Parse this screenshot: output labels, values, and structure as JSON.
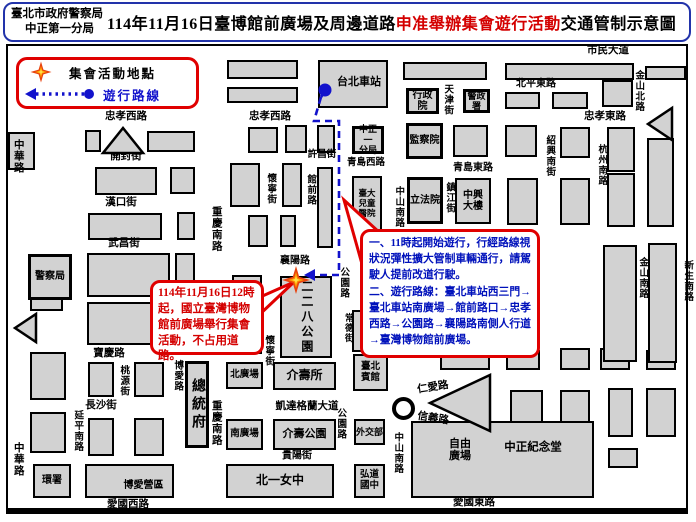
{
  "header": {
    "agency": "臺北市政府警察局",
    "precinct": "中正第一分局",
    "title_part1": "114年11月16日臺博館前廣場及周邊道路",
    "title_red": "申准舉辦集會遊行活動",
    "title_part2": "交通管制示意圖"
  },
  "legend": {
    "assembly_label": "集會活動地點",
    "route_label": "遊行路線"
  },
  "callouts": {
    "assembly_note": "114年11月16日12時起，國立臺灣博物館前廣場舉行集會活動，不占用道路。",
    "route_note": [
      "一、11時起開始遊行，行經路線視狀況彈性擴大管制車輛通行，請駕駛人提前改道行駛。",
      "二、遊行路線：臺北車站西三門→臺北車站南廣場→館前路口→忠孝西路→公園路→襄陽路南側人行道→臺灣博物館前廣場。"
    ]
  },
  "colors": {
    "accent_red": "#e00000",
    "route_blue": "#1212cc",
    "note_blue": "#0011bb",
    "block_gray": "#d2d2d2",
    "header_border_blue": "#2233aa"
  },
  "map": {
    "route": {
      "start": [
        325,
        90
      ],
      "points": [
        [
          321,
          97
        ],
        [
          314,
          121
        ],
        [
          339,
          121
        ],
        [
          339,
          275
        ],
        [
          313,
          275
        ]
      ],
      "arrow_tip": [
        304,
        275
      ],
      "star": [
        296,
        280
      ]
    },
    "roundabout": [
      392,
      397
    ],
    "labels": [
      {
        "text": "市民大道",
        "x": 608,
        "y": 51
      },
      {
        "text": "忠孝西路",
        "x": 126,
        "y": 117
      },
      {
        "text": "忠孝西路",
        "x": 270,
        "y": 117
      },
      {
        "text": "北平東路",
        "x": 536,
        "y": 84,
        "fs": 10
      },
      {
        "text": "忠孝東路",
        "x": 605,
        "y": 117
      },
      {
        "text": "開封街",
        "x": 126,
        "y": 157
      },
      {
        "text": "漢口街",
        "x": 121,
        "y": 203
      },
      {
        "text": "武昌街",
        "x": 124,
        "y": 244
      },
      {
        "text": "許昌街",
        "x": 322,
        "y": 155,
        "fs": 9.5
      },
      {
        "text": "青島西路",
        "x": 366,
        "y": 163,
        "fs": 9.5
      },
      {
        "text": "青島東路",
        "x": 473,
        "y": 168,
        "fs": 10
      },
      {
        "text": "襄陽路",
        "x": 295,
        "y": 261,
        "fs": 10
      },
      {
        "text": "寶慶路",
        "x": 109,
        "y": 354
      },
      {
        "text": "長沙街",
        "x": 101,
        "y": 406
      },
      {
        "text": "凱達格蘭大道",
        "x": 307,
        "y": 407
      },
      {
        "text": "貴陽街",
        "x": 297,
        "y": 456,
        "fs": 10
      },
      {
        "text": "愛國西路",
        "x": 128,
        "y": 505
      },
      {
        "text": "愛國東路",
        "x": 474,
        "y": 503
      },
      {
        "text": "仁愛路",
        "x": 433,
        "y": 388,
        "rot": -9
      },
      {
        "text": "信義路",
        "x": 433,
        "y": 419,
        "rot": 9
      },
      {
        "text": "自由\n廣場",
        "x": 460,
        "y": 450,
        "fs": 11
      },
      {
        "text": "中正紀念堂",
        "x": 533,
        "y": 448,
        "fs": 11.5
      },
      {
        "text": "中華路",
        "x": 18,
        "y": 156,
        "v": true
      },
      {
        "text": "中華路",
        "x": 18,
        "y": 459,
        "v": true
      },
      {
        "text": "重慶南路",
        "x": 216,
        "y": 229,
        "v": true
      },
      {
        "text": "重慶南路",
        "x": 216,
        "y": 423,
        "v": true
      },
      {
        "text": "天津街",
        "x": 447,
        "y": 100,
        "v": true,
        "fs": 9.5
      },
      {
        "text": "金山北路",
        "x": 638,
        "y": 91,
        "v": true,
        "fs": 9.5
      },
      {
        "text": "杭州南路",
        "x": 601,
        "y": 165,
        "v": true,
        "fs": 9.5
      },
      {
        "text": "紹興南街",
        "x": 549,
        "y": 156,
        "v": true,
        "fs": 9.5
      },
      {
        "text": "鎮江街",
        "x": 449,
        "y": 198,
        "v": true,
        "fs": 9.5
      },
      {
        "text": "金山南路",
        "x": 642,
        "y": 278,
        "v": true,
        "fs": 9.5
      },
      {
        "text": "新生南路",
        "x": 687,
        "y": 281,
        "v": true,
        "fs": 9.5
      },
      {
        "text": "館前路",
        "x": 310,
        "y": 190,
        "v": true,
        "fs": 9.5
      },
      {
        "text": "懷寧街",
        "x": 270,
        "y": 189,
        "v": true,
        "fs": 9.5
      },
      {
        "text": "懷寧街",
        "x": 268,
        "y": 351,
        "v": true,
        "fs": 9.5
      },
      {
        "text": "公園路",
        "x": 343,
        "y": 283,
        "v": true,
        "fs": 9.5
      },
      {
        "text": "公園路",
        "x": 340,
        "y": 424,
        "v": true,
        "fs": 9.5
      },
      {
        "text": "中山南路",
        "x": 398,
        "y": 207,
        "v": true,
        "fs": 9.5
      },
      {
        "text": "中山南路",
        "x": 397,
        "y": 453,
        "v": true,
        "fs": 9.5
      },
      {
        "text": "桃源街",
        "x": 123,
        "y": 381,
        "v": true,
        "fs": 9.5
      },
      {
        "text": "博愛路",
        "x": 177,
        "y": 376,
        "v": true,
        "fs": 9.5
      },
      {
        "text": "延平南路",
        "x": 77,
        "y": 431,
        "v": true,
        "fs": 9.5
      },
      {
        "text": "常德街",
        "x": 348,
        "y": 328,
        "v": true,
        "fs": 9
      }
    ],
    "buildings": [
      {
        "name": "taipei-main-station",
        "label": "台北車站",
        "x": 318,
        "y": 60,
        "w": 70,
        "h": 48,
        "fs": 11,
        "dx": 6,
        "dy": -2
      },
      {
        "name": "executive-yuan",
        "label": "行政院",
        "x": 406,
        "y": 88,
        "w": 33,
        "h": 26,
        "fs": 10,
        "imp": true
      },
      {
        "name": "national-police-agency",
        "label": "警政署",
        "x": 463,
        "y": 89,
        "w": 27,
        "h": 24,
        "fs": 9,
        "imp": true
      },
      {
        "name": "zhongzheng-first-precinct",
        "label": "中正一\n分局",
        "x": 352,
        "y": 126,
        "w": 32,
        "h": 28,
        "fs": 9,
        "imp": true
      },
      {
        "name": "control-yuan",
        "label": "監察院",
        "x": 406,
        "y": 123,
        "w": 37,
        "h": 36,
        "fs": 10,
        "imp": true
      },
      {
        "name": "legislative-yuan",
        "label": "立法院",
        "x": 407,
        "y": 177,
        "w": 36,
        "h": 47,
        "fs": 10,
        "imp": true
      },
      {
        "name": "zhongxing-building",
        "label": "中興\n大樓",
        "x": 455,
        "y": 178,
        "w": 36,
        "h": 46,
        "fs": 10
      },
      {
        "name": "ntu-childrens-hospital",
        "label": "臺大\n兒童\n醫院",
        "x": 352,
        "y": 176,
        "w": 30,
        "h": 56,
        "fs": 8.5
      },
      {
        "name": "police-station",
        "label": "警察局",
        "x": 28,
        "y": 254,
        "w": 44,
        "h": 46,
        "fs": 10,
        "imp": true
      },
      {
        "name": "228-park",
        "label": "二二八公園",
        "x": 280,
        "y": 276,
        "w": 52,
        "h": 82,
        "fs": 12,
        "v": true,
        "ls": 3
      },
      {
        "name": "jieshou-hall",
        "label": "介壽所",
        "x": 273,
        "y": 362,
        "w": 63,
        "h": 28,
        "fs": 12
      },
      {
        "name": "north-plaza",
        "label": "北廣場",
        "x": 226,
        "y": 362,
        "w": 37,
        "h": 27,
        "fs": 9.5
      },
      {
        "name": "south-plaza",
        "label": "南廣場",
        "x": 226,
        "y": 419,
        "w": 37,
        "h": 31,
        "fs": 9.5
      },
      {
        "name": "jieshou-park",
        "label": "介壽公園",
        "x": 273,
        "y": 419,
        "w": 63,
        "h": 31,
        "fs": 11
      },
      {
        "name": "ministry-of-foreign-affairs",
        "label": "外交部",
        "x": 354,
        "y": 419,
        "w": 31,
        "h": 26,
        "fs": 9
      },
      {
        "name": "presidential-office",
        "label": "總統府",
        "x": 185,
        "y": 361,
        "w": 24,
        "h": 87,
        "fs": 14,
        "v": true,
        "ls": 4,
        "imp": true
      },
      {
        "name": "taipei-guest-house",
        "label": "臺北\n賓館",
        "x": 353,
        "y": 354,
        "w": 35,
        "h": 37,
        "fs": 9.5
      },
      {
        "name": "taipei-first-girls-high-school",
        "label": "北一女中",
        "x": 226,
        "y": 464,
        "w": 108,
        "h": 34,
        "fs": 12
      },
      {
        "name": "hongdao-junior-high",
        "label": "弘道\n國中",
        "x": 354,
        "y": 464,
        "w": 31,
        "h": 34,
        "fs": 9.5
      },
      {
        "name": "boai-camp",
        "label": "博愛營區",
        "x": 85,
        "y": 464,
        "w": 89,
        "h": 34,
        "fs": 10,
        "dx": 14,
        "dy": 5
      },
      {
        "name": "epa-building",
        "label": "環署",
        "x": 33,
        "y": 464,
        "w": 38,
        "h": 34,
        "fs": 10
      },
      {
        "name": "cks-memorial-hall",
        "label": "",
        "x": 411,
        "y": 421,
        "w": 183,
        "h": 77,
        "fs": 11
      }
    ],
    "blocks": [
      [
        30,
        62,
        166,
        18
      ],
      [
        30,
        87,
        166,
        16
      ],
      [
        227,
        60,
        71,
        19
      ],
      [
        227,
        87,
        71,
        16
      ],
      [
        403,
        62,
        84,
        18
      ],
      [
        505,
        63,
        129,
        17
      ],
      [
        645,
        66,
        41,
        14
      ],
      [
        602,
        80,
        31,
        27
      ],
      [
        505,
        92,
        35,
        17
      ],
      [
        552,
        92,
        36,
        17
      ],
      [
        607,
        127,
        28,
        45
      ],
      [
        607,
        173,
        28,
        54
      ],
      [
        647,
        138,
        27,
        89
      ],
      [
        453,
        125,
        35,
        32
      ],
      [
        505,
        125,
        32,
        32
      ],
      [
        560,
        127,
        30,
        31
      ],
      [
        507,
        178,
        31,
        47
      ],
      [
        560,
        178,
        30,
        47
      ],
      [
        85,
        130,
        16,
        22
      ],
      [
        147,
        131,
        48,
        21
      ],
      [
        95,
        167,
        62,
        28
      ],
      [
        170,
        167,
        25,
        27
      ],
      [
        88,
        213,
        74,
        27
      ],
      [
        177,
        212,
        18,
        28
      ],
      [
        87,
        253,
        83,
        44
      ],
      [
        87,
        302,
        83,
        43
      ],
      [
        175,
        253,
        20,
        44
      ],
      [
        175,
        302,
        20,
        43
      ],
      [
        248,
        127,
        30,
        26
      ],
      [
        285,
        125,
        22,
        28
      ],
      [
        317,
        125,
        18,
        28
      ],
      [
        230,
        163,
        30,
        44
      ],
      [
        282,
        163,
        20,
        44
      ],
      [
        317,
        167,
        16,
        81
      ],
      [
        248,
        215,
        20,
        32
      ],
      [
        280,
        215,
        16,
        32
      ],
      [
        232,
        275,
        30,
        36
      ],
      [
        232,
        318,
        30,
        36
      ],
      [
        8,
        132,
        27,
        38
      ],
      [
        30,
        288,
        33,
        23
      ],
      [
        30,
        352,
        36,
        48
      ],
      [
        30,
        412,
        36,
        41
      ],
      [
        88,
        362,
        26,
        35
      ],
      [
        134,
        362,
        30,
        35
      ],
      [
        88,
        418,
        26,
        38
      ],
      [
        134,
        418,
        30,
        38
      ],
      [
        506,
        350,
        34,
        20
      ],
      [
        560,
        348,
        30,
        22
      ],
      [
        600,
        348,
        30,
        22
      ],
      [
        646,
        350,
        30,
        20
      ],
      [
        510,
        390,
        33,
        43
      ],
      [
        560,
        390,
        30,
        43
      ],
      [
        608,
        388,
        25,
        49
      ],
      [
        646,
        388,
        30,
        49
      ],
      [
        608,
        448,
        30,
        20
      ],
      [
        603,
        245,
        34,
        117
      ],
      [
        648,
        243,
        29,
        120
      ],
      [
        440,
        350,
        50,
        20
      ],
      [
        352,
        310,
        36,
        42
      ]
    ],
    "triangles": [
      "103,153 143,153 123,128",
      "36,314 36,342 15,328",
      "430,403 490,375 490,431",
      "672,108 672,140 648,124"
    ],
    "callout_tails": [
      "258,298 294,282 258,316",
      "380,233 344,200 362,264"
    ]
  }
}
